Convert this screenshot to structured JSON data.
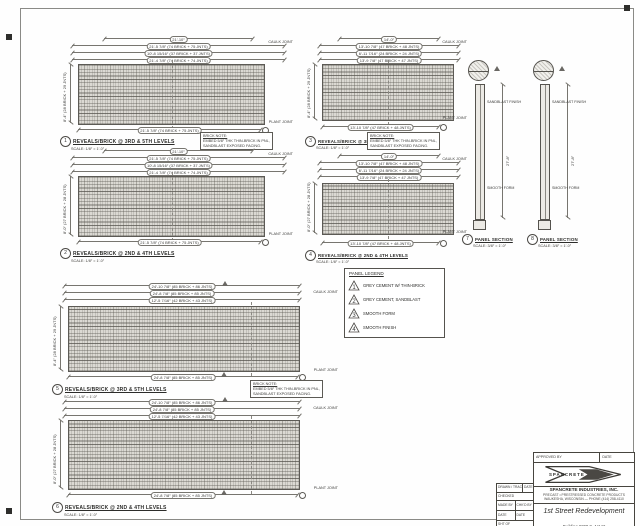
{
  "sheet": {
    "background": "#fefefe",
    "ink": "#55534e"
  },
  "panels": [
    {
      "detail": "1",
      "title": "REVEALS/BRICK @ 3RD & 5TH LEVELS",
      "scale": "SCALE: 1/8″ = 1′-0″",
      "dim_overall": "21′-10″",
      "dims_top": [
        "21′-5 7/8″ (74 BRICK + 75 JNTS)",
        "10′-8 15/16″ (37 BRICK + 37 JNTS)",
        "21′-4 7/8″ (74 BRICK + 74 JNTS)"
      ],
      "dim_bottom": "21′-5 7/8″ (74 BRICK + 75 JNTS)",
      "dim_left": "8′-4″ (28 BRICK + 29 JNTS)",
      "joint_top": "CAULK JOINT",
      "joint_bottom": "PLANT JOINT",
      "note_lines": [
        "BRICK NOTE:",
        "EMBED 5/8″ THK THIN-BRICK IN PNL,",
        "SANDBLAST EXPOSED FACING."
      ]
    },
    {
      "detail": "2",
      "title": "REVEALS/BRICK @ 2ND & 4TH LEVELS",
      "scale": "SCALE: 1/8″ = 1′-0″",
      "dim_overall": "21′-10″",
      "dims_top": [
        "21′-5 7/8″ (74 BRICK + 75 JNTS)",
        "10′-8 15/16″ (37 BRICK + 37 JNTS)",
        "21′-4 7/8″ (74 BRICK + 74 JNTS)"
      ],
      "dim_bottom": "21′-5 7/8″ (74 BRICK + 75 JNTS)",
      "dim_left": "8′-0″ (27 BRICK + 28 JNTS)",
      "joint_top": "CAULK JOINT",
      "joint_bottom": "PLANT JOINT"
    },
    {
      "detail": "3",
      "title": "REVEALS/BRICK @ 3RD & 5TH LEVELS",
      "scale": "SCALE: 1/8″ = 1′-0″",
      "dim_overall": "14′-0″",
      "dims_top": [
        "13′-10 7/8″ (47 BRICK + 48 JNTS)",
        "6′-11 7/16″ (24 BRICK + 24 JNTS)",
        "13′-9 7/8″ (47 BRICK + 47 JNTS)"
      ],
      "dim_bottom": "13′-10 7/8″ (47 BRICK + 48 JNTS)",
      "dim_left": "8′-4″ (28 BRICK + 29 JNTS)",
      "joint_top": "CAULK JOINT",
      "joint_bottom": "PLANT JOINT",
      "note_lines": [
        "BRICK NOTE:",
        "EMBED 5/8″ THK THIN-BRICK IN PNL,",
        "SANDBLAST EXPOSED FACING."
      ]
    },
    {
      "detail": "4",
      "title": "REVEALS/BRICK @ 2ND & 4TH LEVELS",
      "scale": "SCALE: 1/8″ = 1′-0″",
      "dim_overall": "14′-0″",
      "dims_top": [
        "13′-10 7/8″ (47 BRICK + 48 JNTS)",
        "6′-11 7/16″ (24 BRICK + 24 JNTS)",
        "13′-9 7/8″ (47 BRICK + 47 JNTS)"
      ],
      "dim_bottom": "13′-10 7/8″ (47 BRICK + 48 JNTS)",
      "dim_left": "8′-0″ (27 BRICK + 28 JNTS)",
      "joint_top": "CAULK JOINT",
      "joint_bottom": "PLANT JOINT"
    },
    {
      "detail": "5",
      "title": "REVEALS/BRICK @ 3RD & 5TH LEVELS",
      "scale": "SCALE: 1/8″ = 1′-0″",
      "dims_top": [
        "24′-10 7/8″ (85 BRICK + 86 JNTS)",
        "24′-8 7/8″ (85 BRICK + 85 JNTS)",
        "12′-5 7/16″ (42 BRICK + 43 JNTS)"
      ],
      "dim_bottom": "24′-8 7/8″ (85 BRICK + 85 JNTS)",
      "dim_left": "8′-4″ (28 BRICK + 29 JNTS)",
      "joint_top": "CAULK JOINT",
      "joint_bottom": "PLANT JOINT",
      "note_lines": [
        "BRICK NOTE:",
        "EMBED 5/8″ THK THIN-BRICK IN PNL,",
        "SANDBLAST EXPOSED FACING."
      ]
    },
    {
      "detail": "6",
      "title": "REVEALS/BRICK @ 2ND & 4TH LEVELS",
      "scale": "SCALE: 1/8″ = 1′-0″",
      "dims_top": [
        "24′-10 7/8″ (85 BRICK + 86 JNTS)",
        "24′-8 7/8″ (85 BRICK + 85 JNTS)",
        "12′-5 7/16″ (42 BRICK + 43 JNTS)"
      ],
      "dim_bottom": "24′-8 7/8″ (85 BRICK + 85 JNTS)",
      "dim_left": "8′-0″ (27 BRICK + 28 JNTS)",
      "joint_top": "CAULK JOINT",
      "joint_bottom": "PLANT JOINT"
    }
  ],
  "legend": {
    "title": "PANEL LEGEND",
    "items": [
      {
        "mark": "1",
        "label": "GREY CEMENT W/ THIN-BRICK"
      },
      {
        "mark": "2",
        "label": "GREY CEMENT, SANDBLAST"
      },
      {
        "mark": "3",
        "label": "SMOOTH FORM"
      },
      {
        "mark": "4",
        "label": "SMOOTH FINISH"
      }
    ]
  },
  "sections": [
    {
      "detail": "7",
      "caption": "PANEL SECTION",
      "scale": "SCALE: 3/8″ = 1′-0″",
      "height_dim": "27′-8″",
      "top_label": "SANDBLAST FINISH",
      "bottom_label": "SMOOTH FORM"
    },
    {
      "detail": "8",
      "caption": "PANEL SECTION",
      "scale": "SCALE: 3/8″ = 1′-0″",
      "height_dim": "27′-8″",
      "top_label": "SANDBLAST FINISH",
      "bottom_label": "SMOOTH FORM"
    }
  ],
  "titleblock": {
    "approved_label": "APPROVED BY",
    "date_label": "DATE",
    "logo_text": "SPANCRETE",
    "company": "SPANCRETE INDUSTRIES, INC.",
    "address1": "PRECAST • PRESTRESSED CONCRETE PRODUCTS",
    "address2": "WAUKESHA, WISCONSIN — PHONE (414) 258-4110",
    "project": "1st Street Redevelopment",
    "location": "Building #200 S. 1st St",
    "aux": {
      "drawn_label": "DRAWN / TRACED",
      "date_label": "DATE",
      "checked_label": "CHECKED",
      "made_by": "MADE BY",
      "chkd_by": "CHK'D BY",
      "date1": "DATE",
      "date2": "DATE",
      "sheet": "SHT   OF"
    }
  }
}
